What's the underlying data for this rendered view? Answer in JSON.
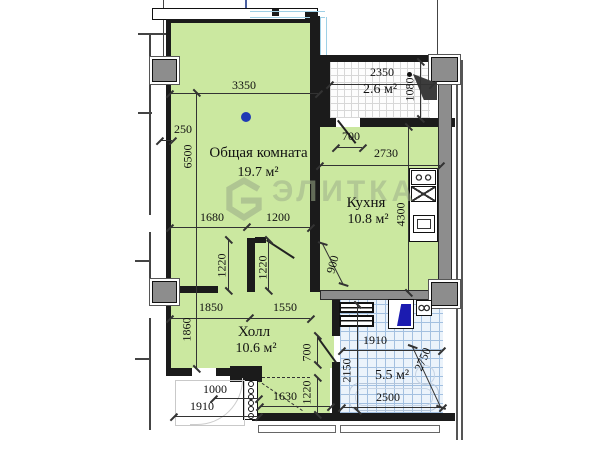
{
  "watermark": {
    "brand": "ЭЛИТКА"
  },
  "rooms": {
    "living": {
      "name": "Общая комната",
      "area": "19.7 м²"
    },
    "kitchen": {
      "name": "Кухня",
      "area": "10.8 м²"
    },
    "hall": {
      "name": "Холл",
      "area": "10.6 м²"
    },
    "bathroom": {
      "area": "5.5 м²"
    },
    "wc": {
      "area": "2.6 м²"
    }
  },
  "dims": {
    "top_3350": "3350",
    "left_250": "250",
    "left_6500": "6500",
    "seg_1680": "1680",
    "seg_1200": "1200",
    "pier_1220_l": "1220",
    "pier_1220_r": "1220",
    "hall_1850": "1850",
    "hall_1550": "1550",
    "hall_1860": "1860",
    "wc_2350": "2350",
    "wc_1080": "1080",
    "door_700_top": "700",
    "kit_2730": "2730",
    "kit_4300": "4300",
    "niche_900": "900",
    "door_700_bath": "700",
    "bath_1910": "1910",
    "bath_2150": "2150",
    "bath_2750": "2750",
    "bath_2500": "2500",
    "vest_1630": "1630",
    "vest_1220": "1220",
    "ent_1000": "1000",
    "ent_1910": "1910"
  },
  "colors": {
    "room_fill": "#cbe8a0",
    "bath_tile": "#ebf3fb",
    "tile_grid": "#a3c0e0",
    "wall": "#1b1b1b",
    "concrete": "#8d8d8d",
    "fixture_navy": "#1b1bb0",
    "glazing": "#9fd0e6",
    "axis_marker": "#1f3ab4",
    "watermark": "#9eae8a"
  }
}
